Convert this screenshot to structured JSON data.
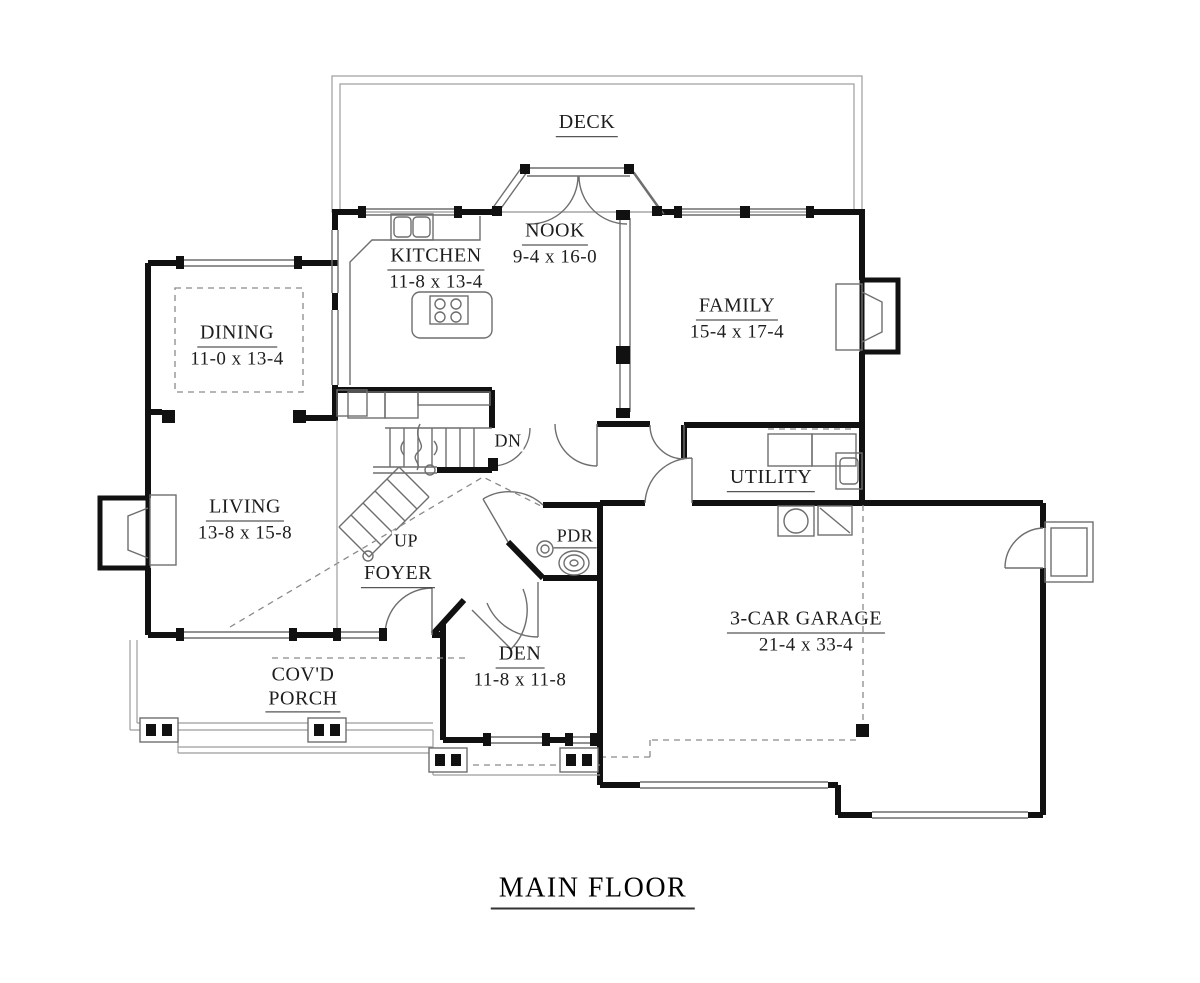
{
  "title": "MAIN FLOOR",
  "rooms": {
    "deck": {
      "name": "DECK"
    },
    "nook": {
      "name": "NOOK",
      "dims": "9-4 x 16-0"
    },
    "kitchen": {
      "name": "KITCHEN",
      "dims": "11-8 x 13-4"
    },
    "family": {
      "name": "FAMILY",
      "dims": "15-4 x 17-4"
    },
    "dining": {
      "name": "DINING",
      "dims": "11-0 x 13-4"
    },
    "living": {
      "name": "LIVING",
      "dims": "13-8 x 15-8"
    },
    "utility": {
      "name": "UTILITY"
    },
    "powder": {
      "name": "PDR"
    },
    "foyer": {
      "name": "FOYER"
    },
    "den": {
      "name": "DEN",
      "dims": "11-8 x 11-8"
    },
    "porch": {
      "line1": "COV'D",
      "line2": "PORCH"
    },
    "garage": {
      "name": "3-CAR GARAGE",
      "dims": "21-4 x 33-4"
    }
  },
  "stairs": {
    "up": "UP",
    "down": "DN"
  }
}
